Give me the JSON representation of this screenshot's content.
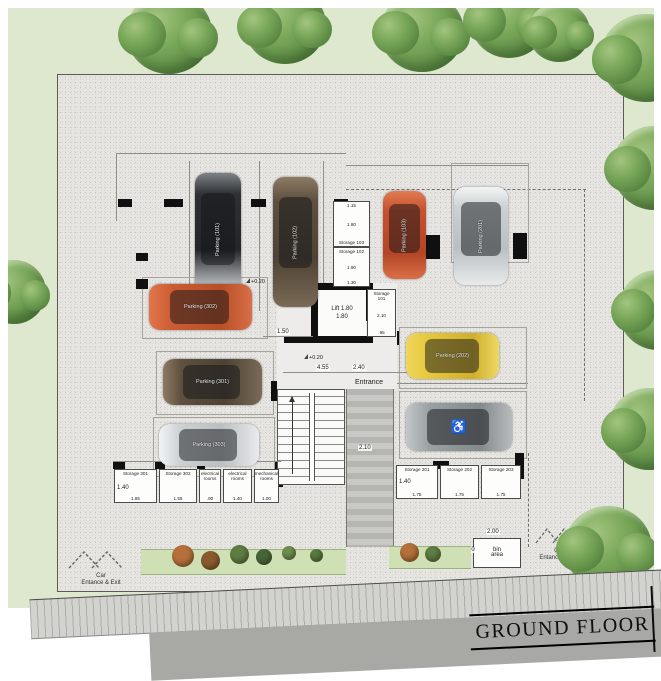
{
  "title": "GROUND FLOOR",
  "colors": {
    "site_bg": "#e6e5e2",
    "surround_green": "#dee8cf",
    "tree_green": "#6f9d52",
    "road_gray": "#d2d2cf",
    "curb_gray": "#a8a8a4",
    "wall_black": "#101010"
  },
  "core": {
    "lift_line1": "Lift 1.80",
    "lift_line2": "1.80",
    "entrance_label": "Entrance",
    "hall_dim_a": "4.55",
    "hall_dim_b": "2.40",
    "lift_side_dim": "1.50",
    "walkway_dim": "2.10",
    "level_a": "+0.20",
    "level_b": "+0.20",
    "level_c": "+0.24"
  },
  "storages_mid": [
    {
      "label": "Storage 103",
      "dim1": "1.15",
      "dim2": "1.80"
    },
    {
      "label": "Storage 102",
      "dim1": "1.90",
      "dim2": "1.30"
    },
    {
      "label": "Storage 101",
      "dim1": "2.10",
      "dim2": ".95"
    }
  ],
  "storages_left": {
    "height_dim": "1.40",
    "rooms": [
      {
        "label": "Storage 301",
        "width_dim": "1.85"
      },
      {
        "label": "Storage 302",
        "width_dim": "1.55"
      },
      {
        "label": "electrical rooms",
        "width_dim": ".90"
      },
      {
        "label": "electrical rooms",
        "width_dim": "1.40"
      },
      {
        "label": "mechanical rooms",
        "width_dim": "1.00"
      }
    ]
  },
  "storages_right": {
    "height_dim": "1.40",
    "rooms": [
      {
        "label": "Storage 201",
        "width_dim": "1.75"
      },
      {
        "label": "Storage 202",
        "width_dim": "1.75"
      },
      {
        "label": "Storage 203",
        "width_dim": "1.75"
      }
    ]
  },
  "parking": [
    {
      "label": "Parking (101)",
      "color": "#3d4044"
    },
    {
      "label": "Parking (102)",
      "color": "#6e5c49"
    },
    {
      "label": "Parking (103)",
      "color": "#c8512e"
    },
    {
      "label": "Parking (201)",
      "color": "#d7dadb"
    },
    {
      "label": "Parking (302)",
      "color": "#cc5c33"
    },
    {
      "label": "Parking (301)",
      "color": "#6e5c49"
    },
    {
      "label": "Parking (303)",
      "color": "#d4d6d6"
    },
    {
      "label": "Parking (202)",
      "color": "#e6c83d"
    },
    {
      "label": "",
      "color": "#9aa0a3",
      "icon": "wheelchair-symbol"
    }
  ],
  "bin_area": {
    "line1": "bin",
    "line2": "area",
    "width_dim": "2.00",
    "height_dim": "1.50"
  },
  "car_entrance_left": {
    "line1": "Car",
    "line2": "Entance & Exit"
  },
  "car_entrance_right": {
    "line1": "Car",
    "line2": "Entance & Exit"
  }
}
